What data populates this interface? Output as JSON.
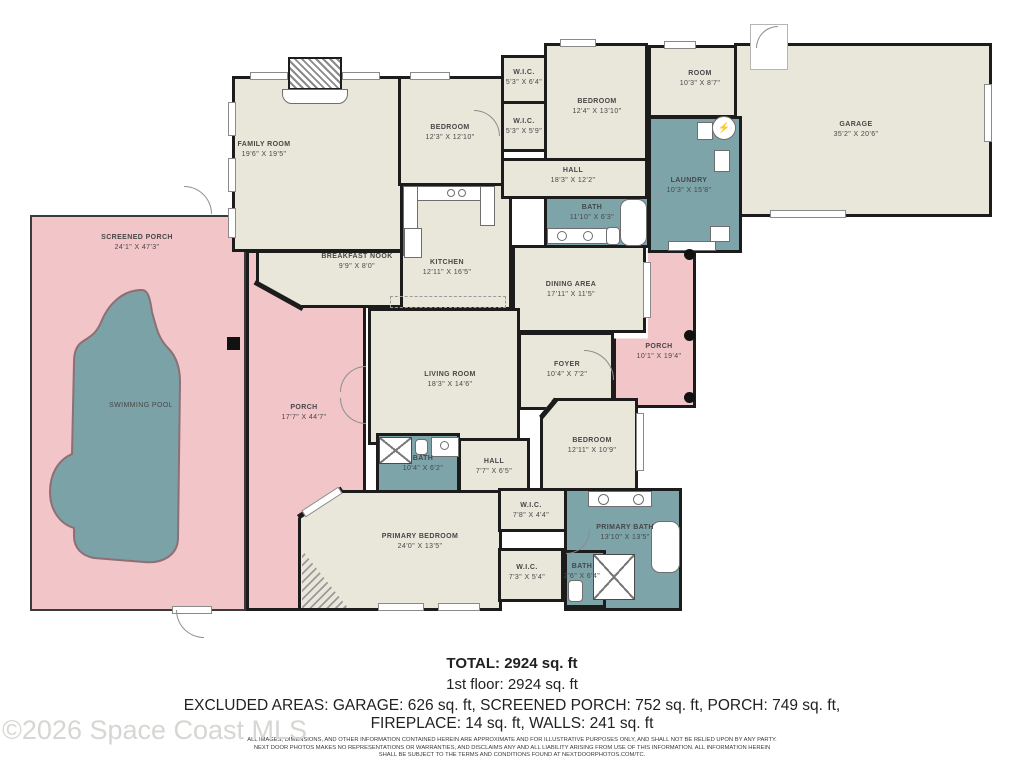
{
  "colors": {
    "interior": "#e9e6da",
    "wet": "#7da4a9",
    "porch": "#f2c5c9",
    "pool": "#7ba2a7",
    "wall": "#1c1c1c"
  },
  "icons": {
    "electrical": "⚡"
  },
  "watermark": "©2026 Space Coast MLS",
  "summary": {
    "total": "TOTAL: 2924 sq. ft",
    "floor": "1st floor: 2924 sq. ft",
    "excluded_line1": "EXCLUDED AREAS: GARAGE: 626 sq. ft, SCREENED PORCH: 752 sq. ft, PORCH: 749 sq. ft,",
    "excluded_line2": "FIREPLACE: 14 sq. ft, WALLS: 241 sq. ft",
    "disclaimer_line1": "ALL IMAGES, DIMENSIONS, AND OTHER INFORMATION CONTAINED HEREIN ARE APPROXIMATE AND FOR ILLUSTRATIVE PURPOSES ONLY, AND SHALL NOT BE RELIED UPON BY ANY PARTY.",
    "disclaimer_line2": "NEXT DOOR PHOTOS MAKES NO REPRESENTATIONS OR WARRANTIES, AND DISCLAIMS ANY AND ALL LIABILITY ARISING FROM USE OF THIS INFORMATION. ALL INFORMATION HEREIN",
    "disclaimer_line3": "SHALL BE SUBJECT TO THE TERMS AND CONDITIONS FOUND AT NEXTDOORPHOTOS.COM/TC."
  },
  "floorplan": {
    "rooms": [
      {
        "id": "screened-porch",
        "category": "porch thin",
        "box": [
          30,
          215,
          216,
          396
        ],
        "label": "SCREENED PORCH",
        "dims": "24'1\" X 47'3\"",
        "label_at": [
          137,
          243
        ]
      },
      {
        "id": "porch-left",
        "category": "porch",
        "box": [
          246,
          250,
          120,
          361
        ],
        "label": "PORCH",
        "dims": "17'7\" X 44'7\"",
        "label_at": [
          304,
          413
        ]
      },
      {
        "id": "porch-back",
        "category": "porch",
        "box": [
          613,
          250,
          83,
          158
        ],
        "clip": "polygon(42% 0, 100% 0, 100% 100%, 0 100%, 0 56%, 42% 56%)",
        "label": "PORCH",
        "dims": "10'1\" X 19'4\"",
        "label_at": [
          659,
          352
        ]
      },
      {
        "id": "family-room",
        "category": "interior",
        "box": [
          232,
          76,
          271,
          176
        ],
        "label": "FAMILY ROOM",
        "dims": "19'6\" X 19'5\"",
        "label_at": [
          264,
          150
        ]
      },
      {
        "id": "breakfast-nook",
        "category": "interior",
        "box": [
          256,
          250,
          147,
          58
        ],
        "clip": "polygon(0 0, 100% 0, 100% 100%, 32% 100%, 0 55%)",
        "label": "BREAKFAST NOOK",
        "dims": "9'9\" X 8'0\"",
        "label_at": [
          357,
          262
        ]
      },
      {
        "id": "bedroom-1",
        "category": "interior",
        "box": [
          398,
          76,
          106,
          110
        ],
        "label": "BEDROOM",
        "dims": "12'3\" X 12'10\"",
        "label_at": [
          450,
          133
        ]
      },
      {
        "id": "kitchen",
        "category": "interior",
        "box": [
          400,
          183,
          112,
          127
        ],
        "label": "KITCHEN",
        "dims": "12'11\" X 16'5\"",
        "label_at": [
          447,
          268
        ]
      },
      {
        "id": "wic-1",
        "category": "interior",
        "box": [
          501,
          55,
          46,
          49
        ],
        "label": "W.I.C.",
        "dims": "5'3\" X 6'4\"",
        "label_at": [
          524,
          78
        ]
      },
      {
        "id": "wic-2",
        "category": "interior",
        "box": [
          501,
          101,
          46,
          51
        ],
        "label": "W.I.C.",
        "dims": "5'3\" X 5'9\"",
        "label_at": [
          524,
          127
        ]
      },
      {
        "id": "bedroom-2",
        "category": "interior",
        "box": [
          544,
          43,
          104,
          118
        ],
        "label": "BEDROOM",
        "dims": "12'4\" X 13'10\"",
        "label_at": [
          597,
          107
        ]
      },
      {
        "id": "room",
        "category": "interior",
        "box": [
          648,
          45,
          94,
          73
        ],
        "label": "ROOM",
        "dims": "10'3\" X 8'7\"",
        "label_at": [
          700,
          79
        ]
      },
      {
        "id": "garage",
        "category": "interior",
        "box": [
          734,
          43,
          258,
          174
        ],
        "label": "GARAGE",
        "dims": "35'2\" X 20'6\"",
        "label_at": [
          856,
          130
        ]
      },
      {
        "id": "hall-1",
        "category": "interior",
        "box": [
          501,
          158,
          147,
          41
        ],
        "label": "HALL",
        "dims": "18'3\" X 12'2\"",
        "label_at": [
          573,
          176
        ]
      },
      {
        "id": "dining-area",
        "category": "interior",
        "box": [
          512,
          245,
          134,
          88
        ],
        "label": "DINING AREA",
        "dims": "17'11\" X 11'5\"",
        "label_at": [
          571,
          290
        ]
      },
      {
        "id": "living-room",
        "category": "interior",
        "box": [
          368,
          308,
          152,
          137
        ],
        "label": "LIVING ROOM",
        "dims": "18'3\" X 14'6\"",
        "label_at": [
          450,
          380
        ]
      },
      {
        "id": "foyer",
        "category": "interior",
        "box": [
          518,
          332,
          96,
          78
        ],
        "label": "FOYER",
        "dims": "10'4\" X 7'2\"",
        "label_at": [
          567,
          370
        ]
      },
      {
        "id": "hall-2",
        "category": "interior",
        "box": [
          458,
          438,
          72,
          55
        ],
        "label": "HALL",
        "dims": "7'7\" X 6'5\"",
        "label_at": [
          494,
          467
        ]
      },
      {
        "id": "bedroom-3",
        "category": "interior",
        "box": [
          540,
          398,
          98,
          95
        ],
        "clip": "polygon(14% 0, 100% 0, 100% 100%, 0 100%, 0 18%)",
        "label": "BEDROOM",
        "dims": "12'11\" X 10'9\"",
        "label_at": [
          592,
          446
        ]
      },
      {
        "id": "primary-bedroom",
        "category": "interior",
        "box": [
          298,
          490,
          204,
          121
        ],
        "clip": "polygon(21% 0, 100% 0, 100% 100%, 0 100%, 0 23%)",
        "label": "PRIMARY BEDROOM",
        "dims": "24'0\" X 13'5\"",
        "label_at": [
          420,
          542
        ]
      },
      {
        "id": "wic-3",
        "category": "interior",
        "box": [
          498,
          488,
          70,
          44
        ],
        "label": "W.I.C.",
        "dims": "7'8\" X 4'4\"",
        "label_at": [
          531,
          511
        ]
      },
      {
        "id": "wic-4",
        "category": "interior",
        "box": [
          498,
          548,
          66,
          54
        ],
        "label": "W.I.C.",
        "dims": "7'3\" X 5'4\"",
        "label_at": [
          527,
          573
        ]
      },
      {
        "id": "bath-1",
        "category": "wet",
        "box": [
          544,
          196,
          106,
          52
        ],
        "label": "BATH",
        "dims": "11'10\" X 6'3\"",
        "label_at": [
          592,
          213
        ]
      },
      {
        "id": "laundry",
        "category": "wet",
        "box": [
          648,
          116,
          94,
          137
        ],
        "label": "LAUNDRY",
        "dims": "10'3\" X 15'8\"",
        "label_at": [
          689,
          186
        ]
      },
      {
        "id": "bath-2",
        "category": "wet",
        "box": [
          376,
          433,
          84,
          60
        ],
        "label": "BATH",
        "dims": "10'4\" X 6'2\"",
        "label_at": [
          423,
          464
        ]
      },
      {
        "id": "primary-bath",
        "category": "wet",
        "box": [
          564,
          488,
          118,
          123
        ],
        "label": "PRIMARY BATH",
        "dims": "13'10\" X 13'5\"",
        "label_at": [
          625,
          533
        ]
      },
      {
        "id": "bath-3",
        "category": "wet",
        "box": [
          564,
          550,
          42,
          58
        ],
        "label": "BATH",
        "dims": "2'6\" X 6'4\"",
        "label_at": [
          582,
          572
        ]
      },
      {
        "id": "swimming-pool",
        "category": "pool",
        "box": null,
        "label": "SWIMMING POOL",
        "dims": null,
        "label_at": [
          141,
          406
        ]
      }
    ],
    "columns": [
      {
        "shape": "dot",
        "at": [
          684,
          249,
          11
        ]
      },
      {
        "shape": "dot",
        "at": [
          684,
          330,
          11
        ]
      },
      {
        "shape": "dot",
        "at": [
          684,
          392,
          11
        ]
      },
      {
        "shape": "square",
        "at": [
          227,
          337,
          13
        ]
      }
    ]
  }
}
